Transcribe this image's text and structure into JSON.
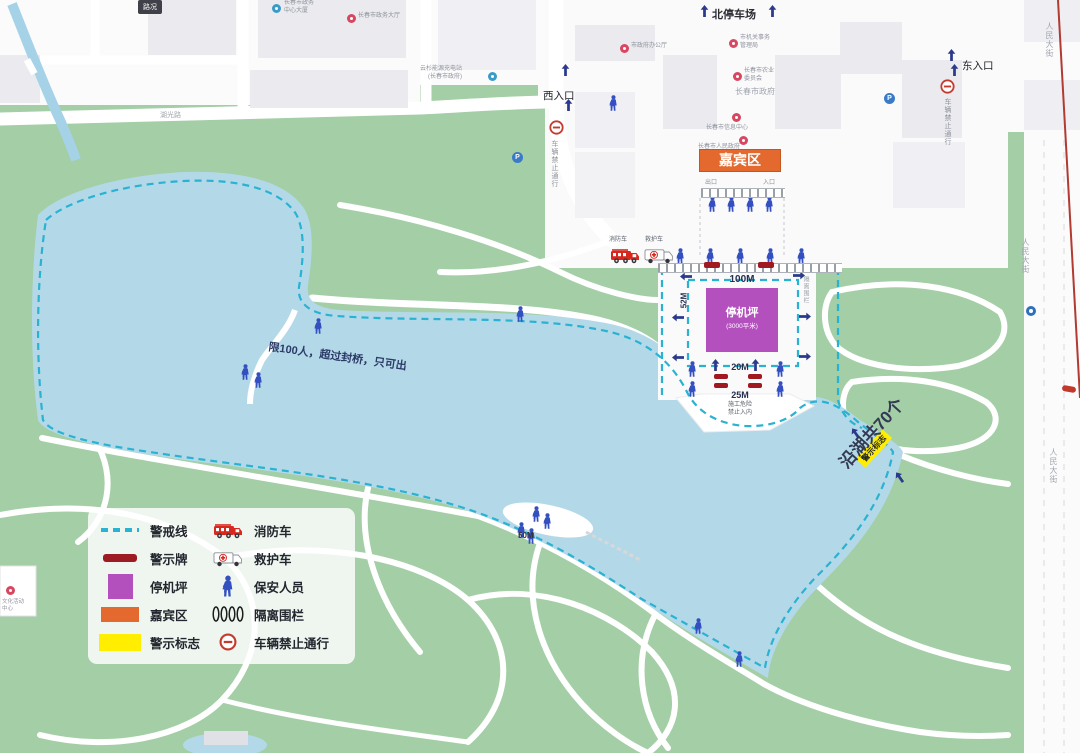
{
  "chips": {
    "traffic": "路况"
  },
  "entrances": {
    "north": "北停车场",
    "west": "西入口",
    "east": "东入口",
    "exit": "出口",
    "entry": "入口"
  },
  "banner": {
    "guest_area": "嘉宾区"
  },
  "helipad": {
    "name": "停机坪",
    "area": "(3000平米)"
  },
  "distances": {
    "d100": "100M",
    "d52": "52M",
    "d20": "20M",
    "d25": "25M",
    "d50": "50M"
  },
  "notices": {
    "bridge_limit": "限100人，超过封桥，只可出",
    "construction_1": "施工危险",
    "construction_2": "禁止入内",
    "lakeside_sign": "警示标志",
    "lakeside_total": "沿湖共70个",
    "no_vehicles": "车辆禁止通行",
    "isolation": "隔离围栏"
  },
  "roads": {
    "renmin": "人民大街",
    "huguang": "湖光路"
  },
  "vehicles": {
    "fire": "消防车",
    "ambulance": "救护车"
  },
  "icons": {
    "parking": "P"
  },
  "pois": {
    "p1a": "长春市政务",
    "p1b": "中心大厦",
    "p2": "长春市政务大厅",
    "p3": "市政府办公厅",
    "p4a": "市机关事务",
    "p4b": "管理局",
    "p5a": "长春市农业",
    "p5b": "委员会",
    "gov": "长春市政府",
    "p6": "长春市信息中心",
    "p7": "长春市人民政府",
    "p8a": "文化活动",
    "p8b": "中心",
    "charge1": "云杉能源充电站",
    "charge2": "(长春市政府)"
  },
  "legend": {
    "left": [
      {
        "label": "警戒线"
      },
      {
        "label": "警示牌"
      },
      {
        "label": "停机坪"
      },
      {
        "label": "嘉宾区"
      },
      {
        "label": "警示标志"
      }
    ],
    "right": [
      {
        "label": "消防车"
      },
      {
        "label": "救护车"
      },
      {
        "label": "保安人员"
      },
      {
        "label": "隔离围栏"
      },
      {
        "label": "车辆禁止通行"
      }
    ]
  },
  "colors": {
    "cordon": "#29b2d2",
    "lake": "#b3d9e9",
    "park_green": "#a3cea6",
    "helipad_purple": "#b44fbe",
    "guest_orange": "#e4692e",
    "warning_yellow": "#ffee00",
    "sign_red": "#9d1b22",
    "person_blue": "#3450c0",
    "pin_red": "#d8465f"
  }
}
